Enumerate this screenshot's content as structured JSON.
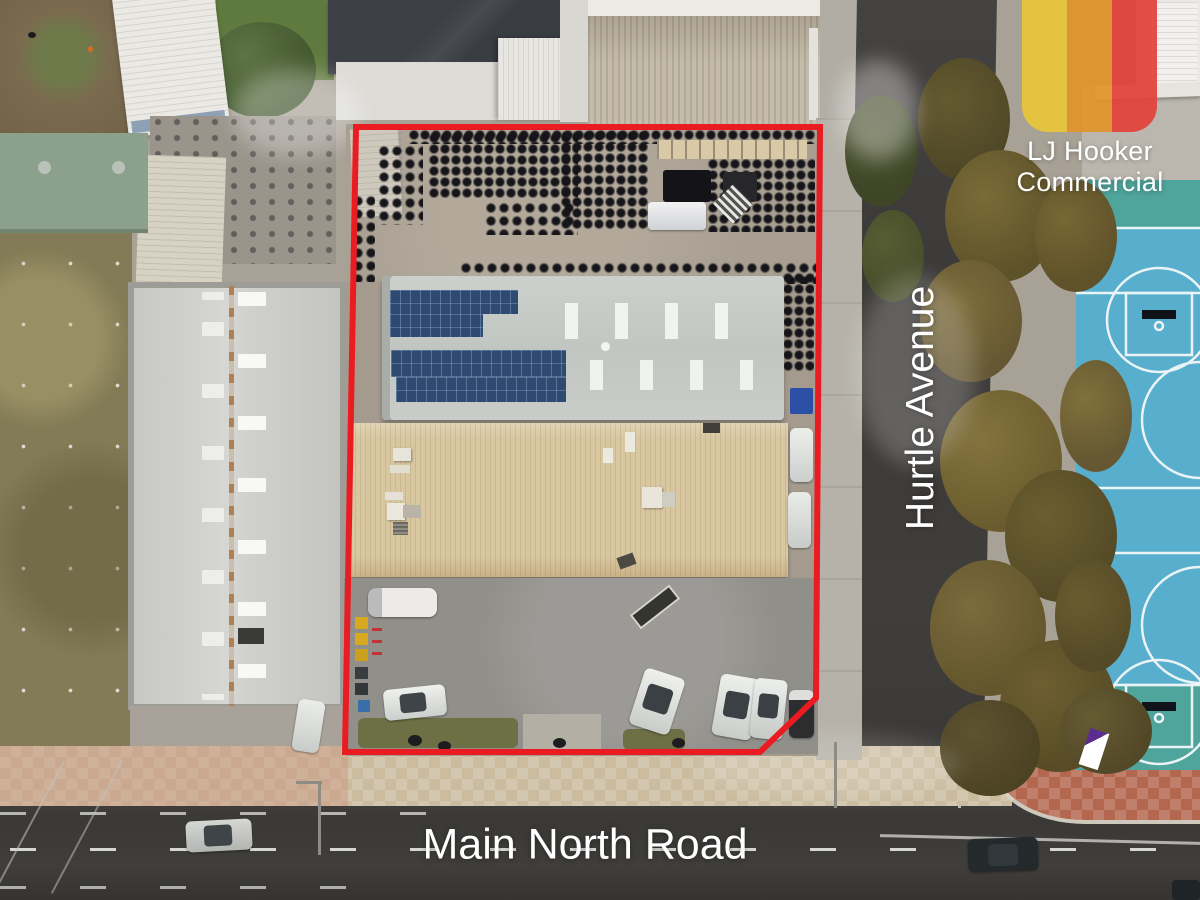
{
  "labels": {
    "street_vertical": "Hurtle Avenue",
    "street_horizontal": "Main North Road"
  },
  "brand": {
    "line1": "LJ Hooker",
    "line2": "Commercial",
    "stripe_yellow": "#E9C63B",
    "stripe_orange": "#E2952C",
    "stripe_red": "#E2423A"
  },
  "boundary": {
    "color": "#EA1C22"
  },
  "scene_colors": {
    "basketball_court_blue": "#57AECD",
    "court_end_green": "#4FA49B",
    "asphalt_road": "#3C3B38",
    "tan_roof": "#D8C7A0",
    "gray_roof": "#C6CAC6",
    "terracotta_paving": "#B5674E"
  }
}
